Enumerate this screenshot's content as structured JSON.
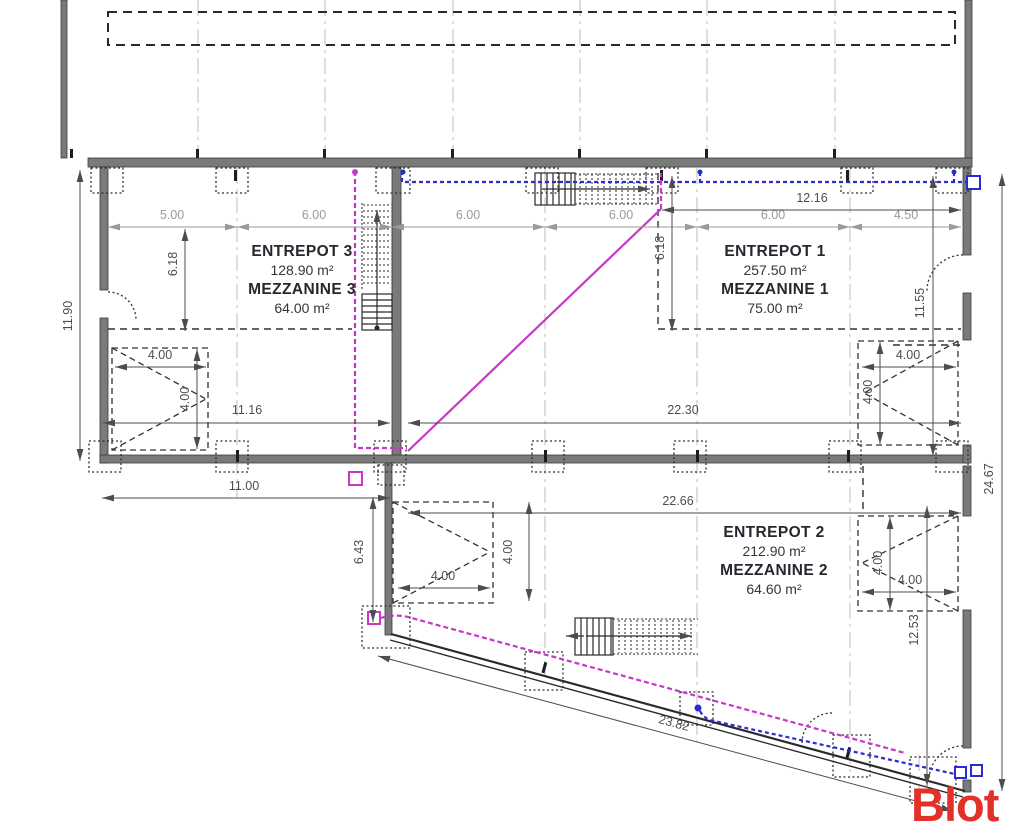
{
  "meta": {
    "watermark": "Blot"
  },
  "colors": {
    "wall_gray": "#7a7a7a",
    "dim_dark": "#4d4d4d",
    "dim_gray": "#9a9a9c",
    "magenta": "#c837c8",
    "blue": "#2b2bd4",
    "watermark_red": "#e23128"
  },
  "rooms": {
    "e3": {
      "name": "ENTREPOT 3",
      "area": "128.90 m²",
      "mezz": "MEZZANINE 3",
      "mezz_area": "64.00 m²"
    },
    "e1": {
      "name": "ENTREPOT 1",
      "area": "257.50 m²",
      "mezz": "MEZZANINE 1",
      "mezz_area": "75.00 m²"
    },
    "e2": {
      "name": "ENTREPOT 2",
      "area": "212.90 m²",
      "mezz": "MEZZANINE 2",
      "mezz_area": "64.60 m²"
    }
  },
  "dims": {
    "top_row": [
      "5.00",
      "6.00",
      "6.00",
      "6.00",
      "6.00",
      "4.50"
    ],
    "width_mezz1": "12.16",
    "left_height": "11.90",
    "mezz3_depth": "6.18",
    "mezz1_depth": "6.18",
    "right_height_e1": "11.55",
    "total_height": "24.67",
    "e3_width_in": "11.16",
    "e1_width_in": "22.30",
    "e3_width_out": "11.00",
    "e2_width": "22.66",
    "e2_left_height": "6.43",
    "e2_right_height": "12.53",
    "e2_slant_length": "23.82",
    "door_width": "4.00"
  }
}
